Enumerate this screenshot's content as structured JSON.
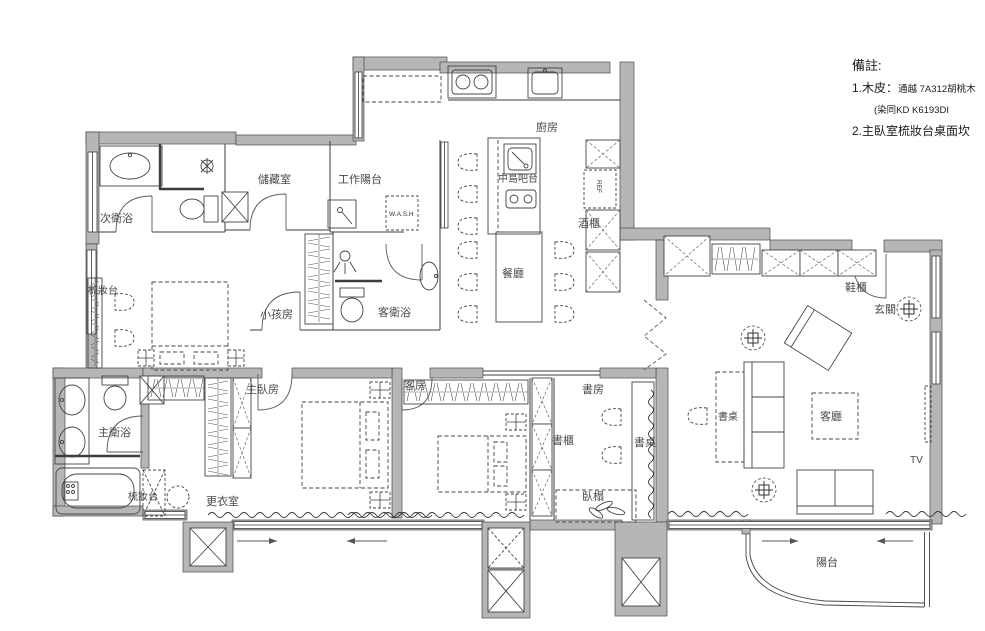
{
  "title": "apartment-floor-plan",
  "colors": {
    "wall": "#b6b6b6",
    "line": "#3c3c3c",
    "label": "#4a4a4a"
  },
  "notes": {
    "heading": "備註:",
    "line1a": "1.木皮：",
    "line1b": "通越 7A312胡桃木",
    "line2": "(染同KD K6193DI",
    "line3": "2.主臥室梳妝台桌面坎"
  },
  "rooms": {
    "secondary_bath": "次衛浴",
    "storage": "儲藏室",
    "work_balcony": "工作陽台",
    "washer": "W.A.S.H",
    "kitchen": "廚房",
    "island_bar": "中島吧台",
    "fridge": "REF",
    "wine_cabinet": "酒櫃",
    "dining": "餐廳",
    "vanity_1": "梳妝台",
    "kids_room": "小孩房",
    "guest_bath": "客衛浴",
    "shoe_cabinet": "鞋櫃",
    "foyer": "玄關",
    "master_bedroom": "主臥房",
    "guest_room": "客房",
    "study": "書房",
    "bookcase": "書櫃",
    "desk_study": "書桌",
    "desk_living": "書桌",
    "living_room": "客廳",
    "tv": "TV",
    "master_bath": "主衛浴",
    "vanity_2": "梳妝台",
    "walk_in_closet": "更衣室",
    "daybed": "臥榻",
    "balcony": "陽台"
  }
}
